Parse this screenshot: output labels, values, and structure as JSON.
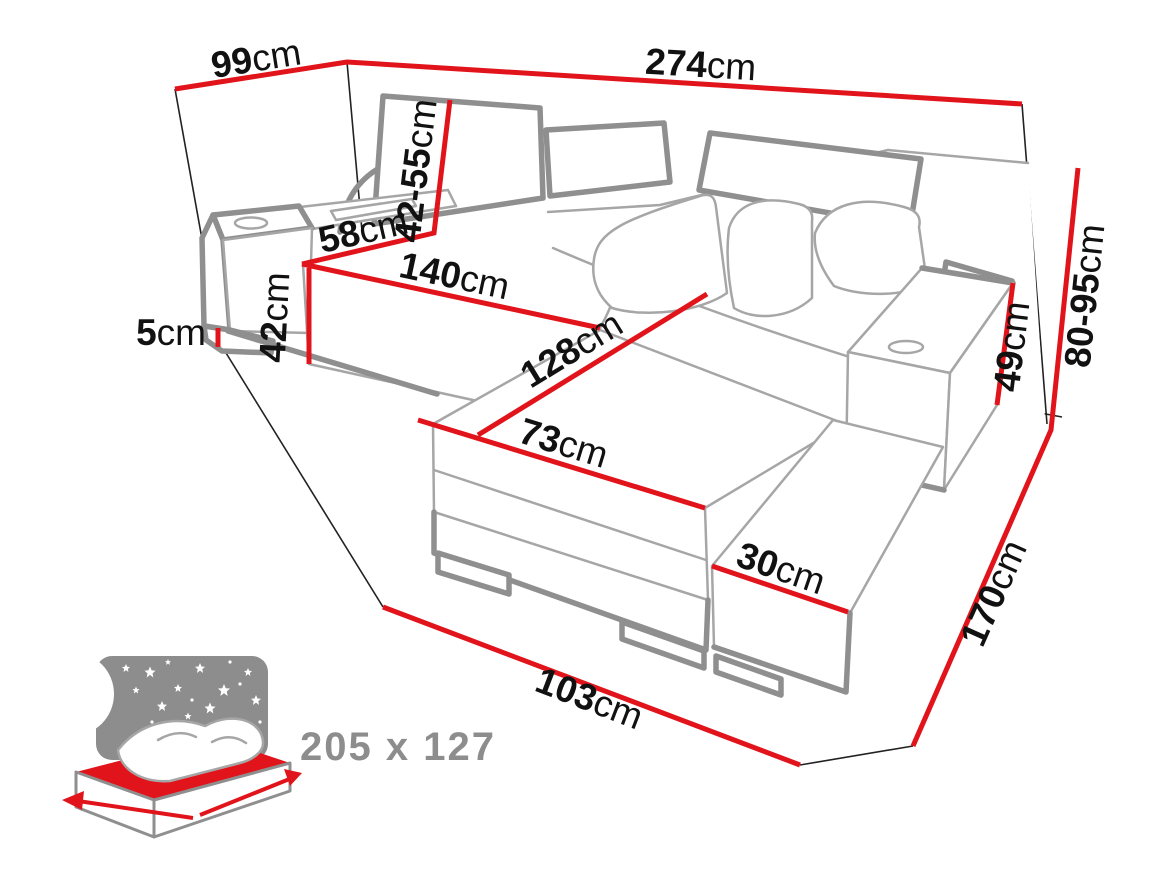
{
  "diagram": {
    "labels": {
      "w99": {
        "num": "99",
        "unit": "cm"
      },
      "w274": {
        "num": "274",
        "unit": "cm"
      },
      "h4255": {
        "num": "42-55",
        "unit": "cm"
      },
      "w58": {
        "num": "58",
        "unit": "cm"
      },
      "w140": {
        "num": "140",
        "unit": "cm"
      },
      "h42": {
        "num": "42",
        "unit": "cm"
      },
      "h5": {
        "num": "5",
        "unit": "cm"
      },
      "l128": {
        "num": "128",
        "unit": "cm"
      },
      "w73": {
        "num": "73",
        "unit": "cm"
      },
      "w30": {
        "num": "30",
        "unit": "cm"
      },
      "w103": {
        "num": "103",
        "unit": "cm"
      },
      "d170": {
        "num": "170",
        "unit": "cm"
      },
      "h8095": {
        "num": "80-95",
        "unit": "cm"
      },
      "h49": {
        "num": "49",
        "unit": "cm"
      }
    },
    "sleeping_area_label": "205 x 127",
    "icons": {
      "sleeping_icon": "bed-night-sky"
    },
    "colors": {
      "dimension_red": "#e2141b",
      "outline_thin": "#a6a6a6",
      "outline_thick": "#8f8f8f",
      "wall_line": "#222222",
      "label_text": "#111111",
      "sleeping_gray": "#8d8d8d"
    }
  }
}
